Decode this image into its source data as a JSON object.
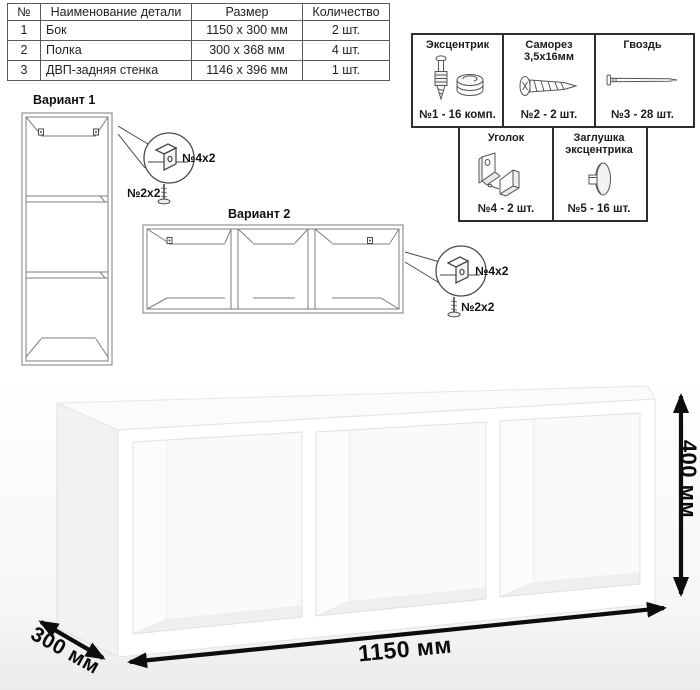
{
  "parts_table": {
    "headers": [
      "№",
      "Наименование детали",
      "Размер",
      "Количество"
    ],
    "rows": [
      {
        "num": "1",
        "name": "Бок",
        "size": "1150 x 300 мм",
        "qty": "2 шт."
      },
      {
        "num": "2",
        "name": "Полка",
        "size": "300 x 368 мм",
        "qty": "4 шт."
      },
      {
        "num": "3",
        "name": "ДВП-задняя стенка",
        "size": "1146 x 396 мм",
        "qty": "1 шт."
      }
    ]
  },
  "hardware": {
    "items": [
      {
        "title": "Эксцентрик",
        "sub": "",
        "count": "№1 - 16 комп."
      },
      {
        "title": "Саморез",
        "sub": "3,5х16мм",
        "count": "№2 - 2 шт."
      },
      {
        "title": "Гвоздь",
        "sub": "",
        "count": "№3 - 28 шт."
      },
      {
        "title": "Уголок",
        "sub": "",
        "count": "№4 - 2 шт."
      },
      {
        "title": "Заглушка",
        "sub": "эксцентрика",
        "count": "№5 - 16 шт."
      }
    ]
  },
  "variants": {
    "variant1": {
      "title": "Вариант 1",
      "bracket_label": "№4х2",
      "screw_label": "№2х2"
    },
    "variant2": {
      "title": "Вариант 2",
      "bracket_label": "№4х2",
      "screw_label": "№2х2"
    }
  },
  "dimensions": {
    "width": "1150 мм",
    "depth": "300 мм",
    "height": "400 мм"
  }
}
